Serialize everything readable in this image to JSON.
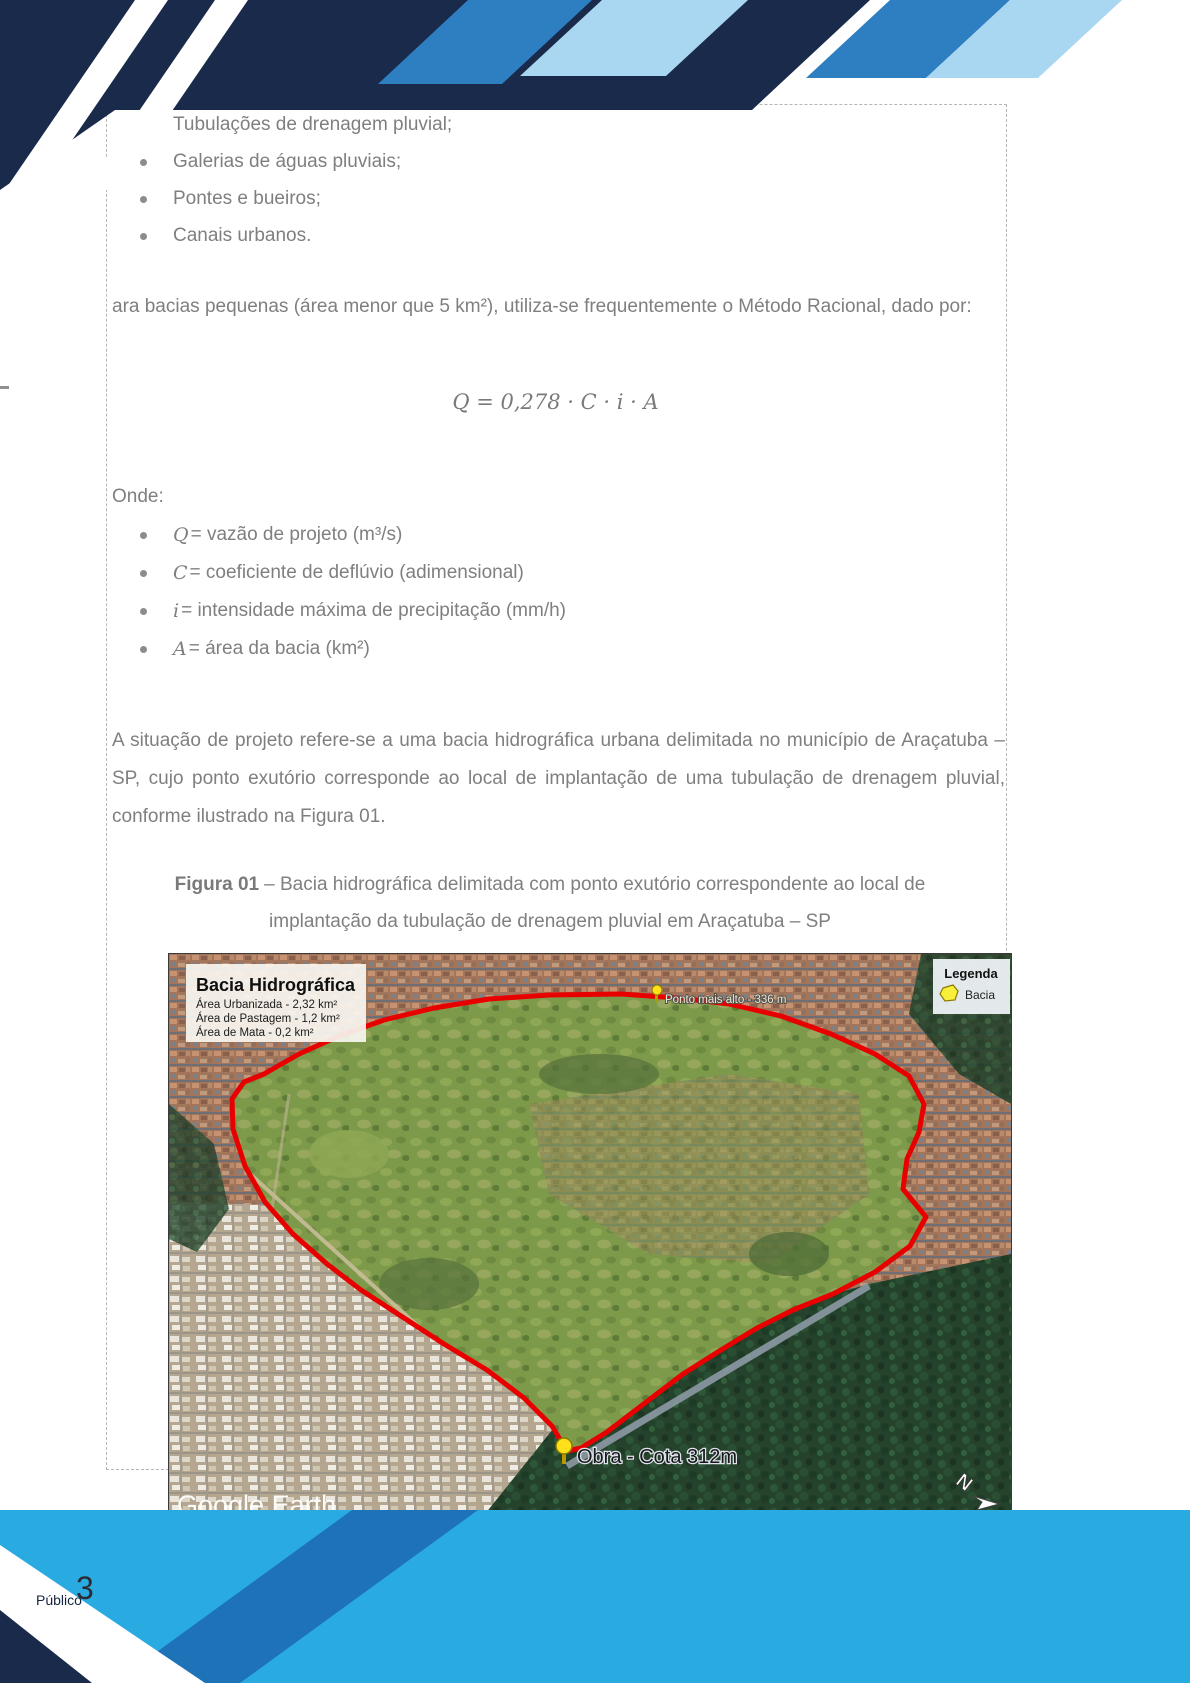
{
  "document": {
    "page_number": "3",
    "footer_classification": "Público",
    "bullets_infrastructure": [
      "Tubulações de drenagem pluvial;",
      "Galerias de águas pluviais;",
      "Pontes e bueiros;",
      "Canais urbanos."
    ],
    "paragraph_method": "ara bacias pequenas (área menor que 5 km²), utiliza-se frequentemente o Método Racional, dado por:",
    "formula": "Q = 0,278 · C · i · A",
    "onde_label": "Onde:",
    "definitions": [
      {
        "symbol": "Q",
        "desc": "= vazão de projeto (m³/s)"
      },
      {
        "symbol": "C",
        "desc": "= coeficiente de deflúvio (adimensional)"
      },
      {
        "symbol": "i",
        "desc": "= intensidade máxima de precipitação (mm/h)"
      },
      {
        "symbol": "A",
        "desc": "= área da bacia (km²)"
      }
    ],
    "paragraph_situation": "A situação de projeto refere-se a uma bacia hidrográfica urbana delimitada no município de Araçatuba – SP, cujo ponto exutório corresponde ao local de implantação de uma tubulação de drenagem pluvial, conforme ilustrado na Figura 01.",
    "figure_caption_label": "Figura 01",
    "figure_caption_text": "– Bacia hidrográfica delimitada com ponto exutório correspondente ao local de implantação da tubulação de drenagem pluvial em Araçatuba – SP"
  },
  "map": {
    "info_box": {
      "title": "Bacia Hidrográfica",
      "area_lines": [
        "Área Urbanizada - 2,32 km²",
        "Área de Pastagem - 1,2 km²",
        "Área de Mata - 0,2 km²"
      ]
    },
    "legend": {
      "title": "Legenda",
      "item_label": "Bacia"
    },
    "pin_high_point": "Ponto mais alto - 336 m",
    "pin_work_site": "Obra - Cota 312m",
    "watermark": "Google Earth",
    "attribution": "Image © 2023 Airbus",
    "scale_label": "200 m",
    "north_label": "N"
  },
  "colors": {
    "navy": "#1a2a4a",
    "cyan_band": "#29abe2",
    "medium_blue": "#2e7fc1",
    "dark_blue_stripe": "#1e73b8",
    "pale_blue": "#a9d6f0",
    "boundary_red": "#e80000",
    "body_text_gray": "#7f7f7f",
    "pin_yellow": "#ffe01a"
  }
}
